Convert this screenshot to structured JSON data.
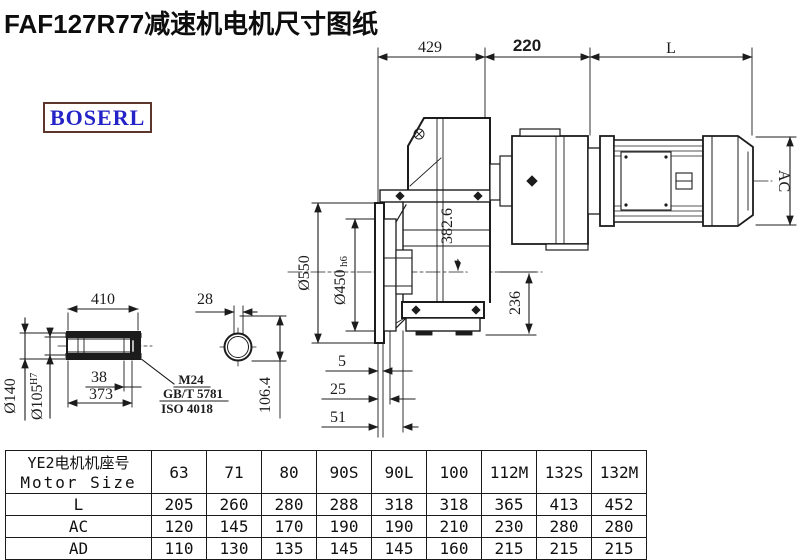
{
  "title": "FAF127R77减速机电机尺寸图纸",
  "logo": "BOSERL",
  "drawing": {
    "dims": {
      "d429": "429",
      "d220": "220",
      "dL": "L",
      "dAC": "AC",
      "d550": "Ø550",
      "d450": "Ø450",
      "d450_tol": "h6",
      "d382": "382.6",
      "d236": "236",
      "d5": "5",
      "d25": "25",
      "d51": "51",
      "d410": "410",
      "d28": "28",
      "d140": "Ø140",
      "d105": "Ø105",
      "d105_tol": "H7",
      "d38": "38",
      "d373": "373",
      "d106": "106.4",
      "note_thread": "M24",
      "note_gbt": "GB/T 5781",
      "note_iso": "ISO 4018"
    }
  },
  "table": {
    "header_cn": "YE2电机机座号",
    "header_en": "Motor Size",
    "columns": [
      "63",
      "71",
      "80",
      "90S",
      "90L",
      "100",
      "112M",
      "132S",
      "132M"
    ],
    "rows": [
      {
        "label": "L",
        "values": [
          "205",
          "260",
          "280",
          "288",
          "318",
          "318",
          "365",
          "413",
          "452"
        ]
      },
      {
        "label": "AC",
        "values": [
          "120",
          "145",
          "170",
          "190",
          "190",
          "210",
          "230",
          "280",
          "280"
        ]
      },
      {
        "label": "AD",
        "values": [
          "110",
          "130",
          "135",
          "145",
          "145",
          "160",
          "215",
          "215",
          "215"
        ]
      }
    ]
  },
  "colors": {
    "line": "#1c1c1c",
    "logo_text": "#2323c8",
    "logo_border": "#5c352d"
  }
}
